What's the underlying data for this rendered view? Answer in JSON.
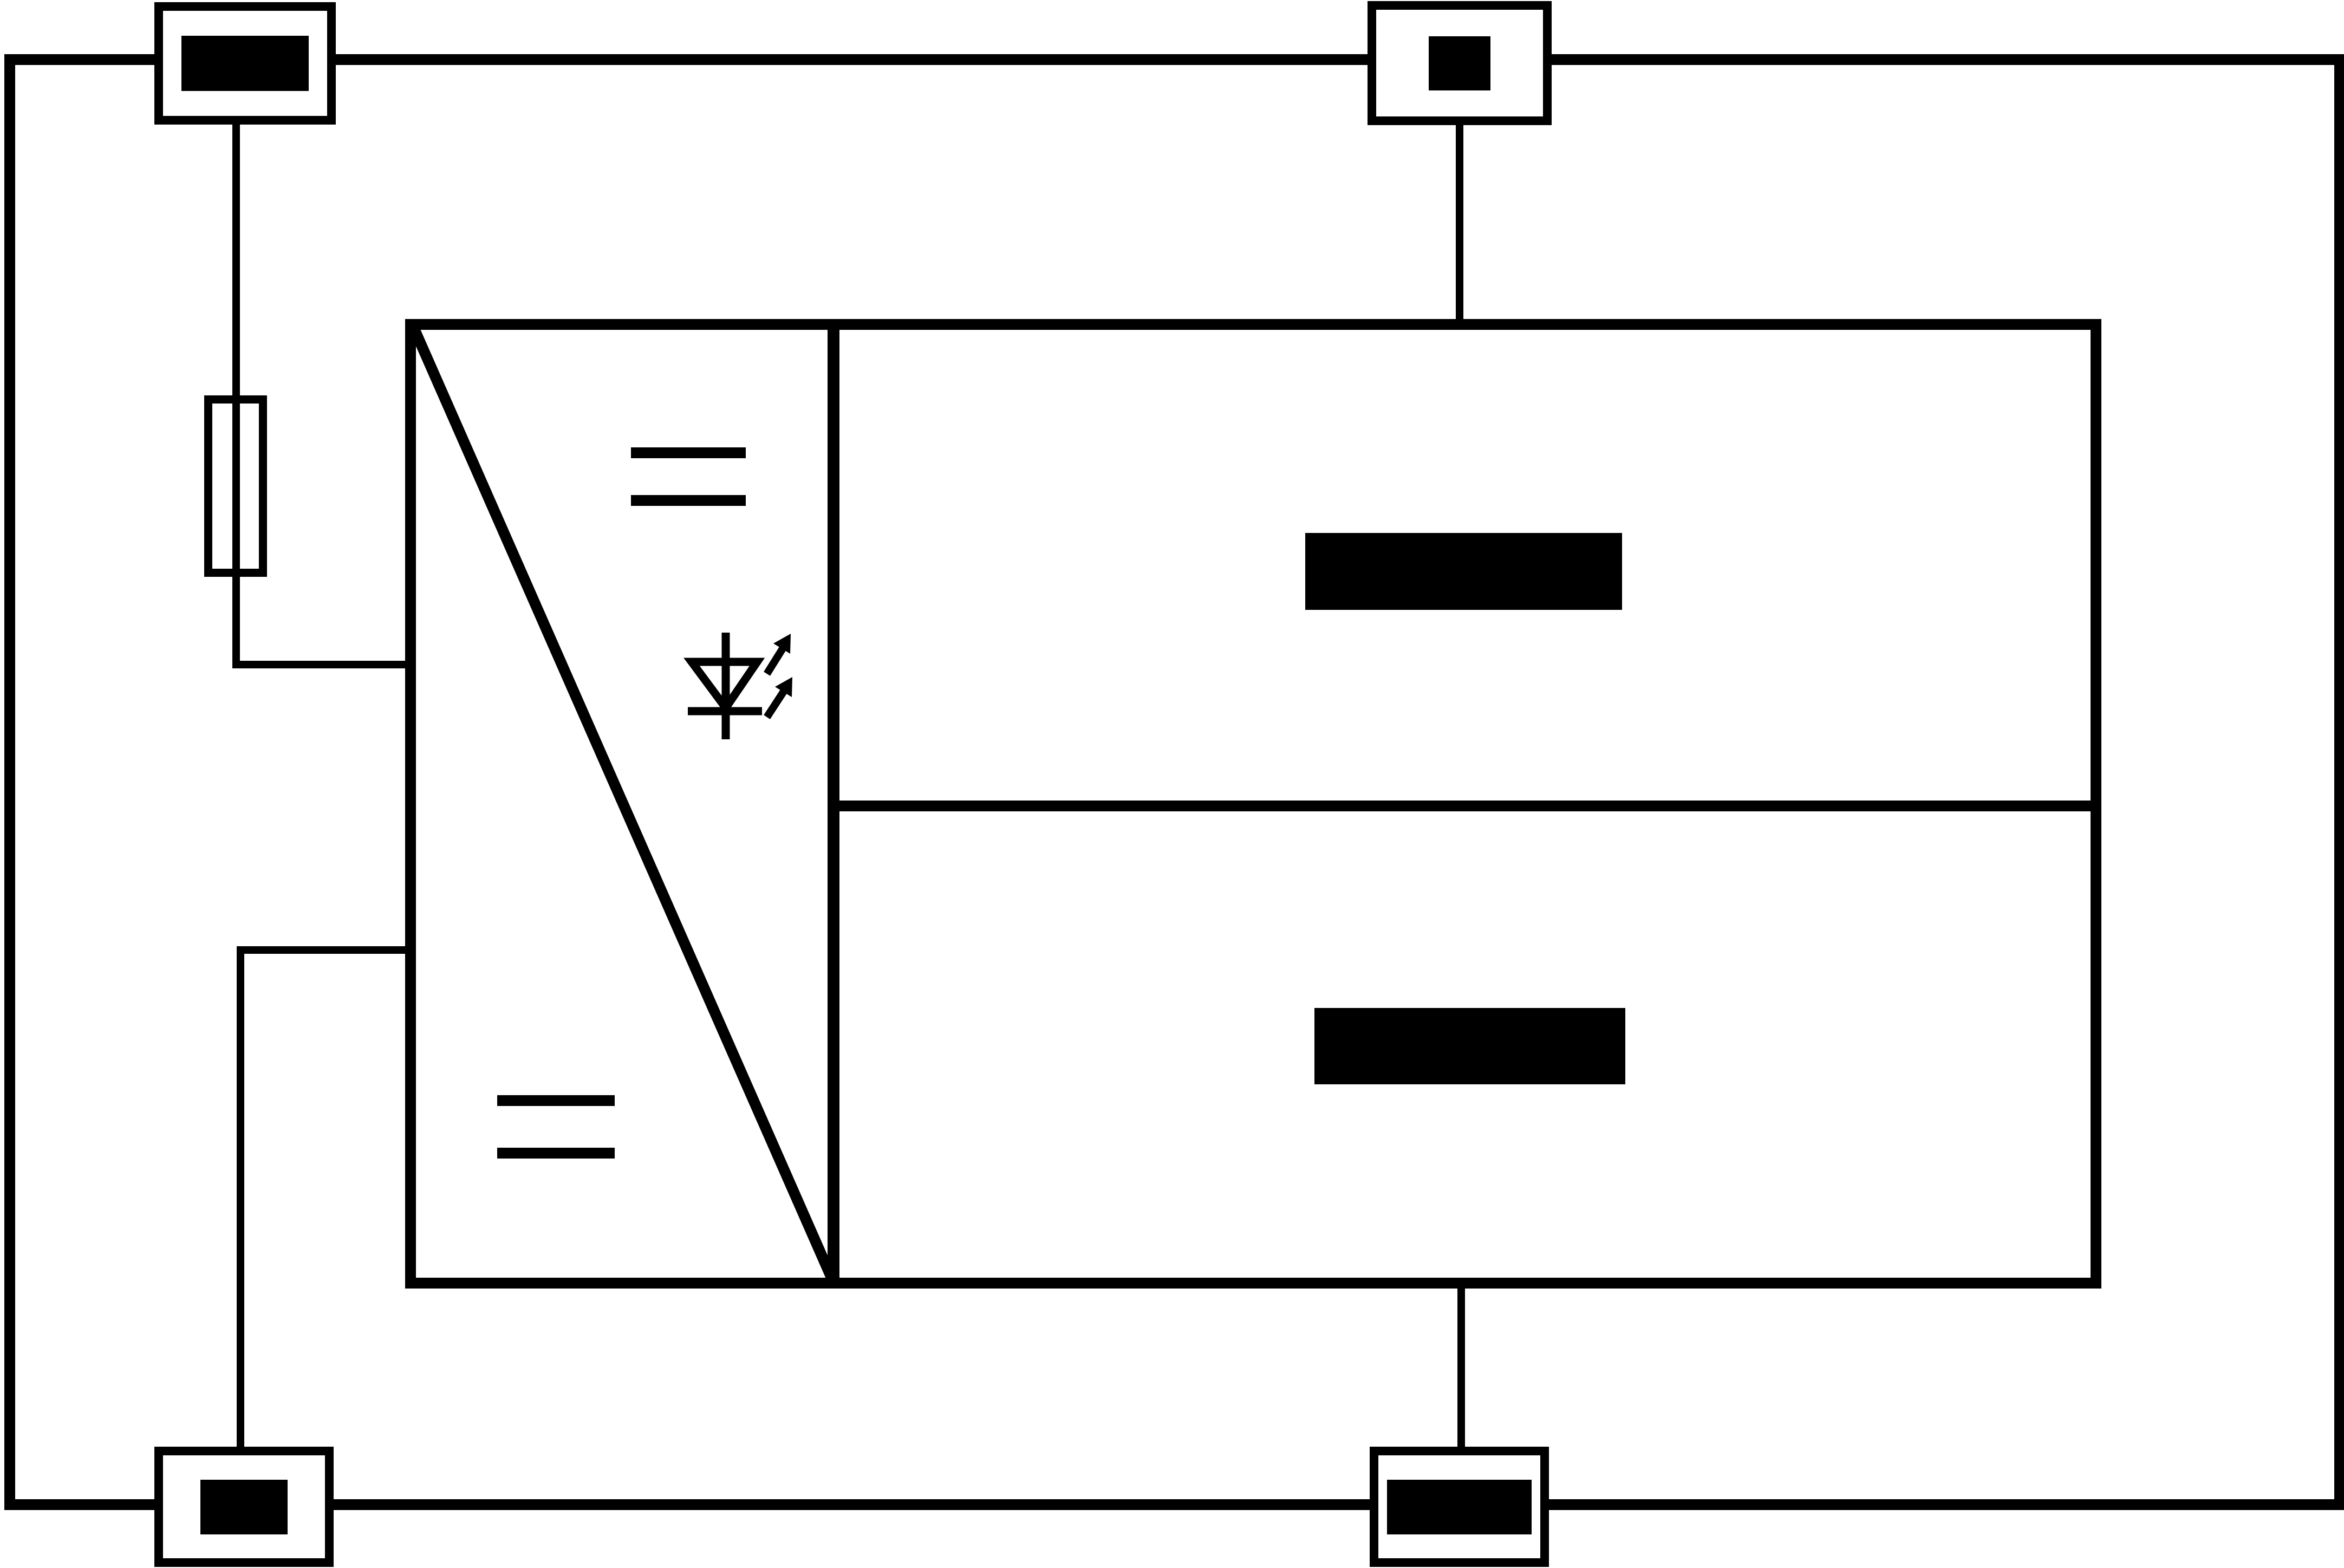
{
  "diagram": {
    "kind": "electrical-schematic",
    "colors": {
      "line": "#000000",
      "background": "#ffffff",
      "redaction": "#000000"
    },
    "enclosure": {
      "name": "outer enclosure frame",
      "shape": "rectangle"
    },
    "terminals": [
      {
        "position": "top-left",
        "label_state": "redacted-black-bar"
      },
      {
        "position": "top-center",
        "label_state": "redacted-black-square"
      },
      {
        "position": "bottom-left",
        "label_state": "redacted-black-bar"
      },
      {
        "position": "bottom-center",
        "label_state": "redacted-black-bar"
      }
    ],
    "fuse": {
      "symbol": "fuse (rectangle with wire passing through)"
    },
    "converter": {
      "symbol": "DC/DC converter block with corner-to-corner diagonal",
      "input_mark": "DC double bar (=) upper section",
      "output_mark": "DC double bar (=) lower section",
      "indicator": "LED diode symbol with two emission arrows"
    },
    "blocks": [
      {
        "position": "upper-right",
        "label_state": "redacted-black-bar"
      },
      {
        "position": "lower-right",
        "label_state": "redacted-black-bar"
      }
    ],
    "wires": [
      "top-left terminal to fuse to converter left side (upper)",
      "converter left side (lower) to bottom-left terminal",
      "top-center terminal to converter top edge",
      "converter bottom edge to bottom-center terminal"
    ]
  }
}
